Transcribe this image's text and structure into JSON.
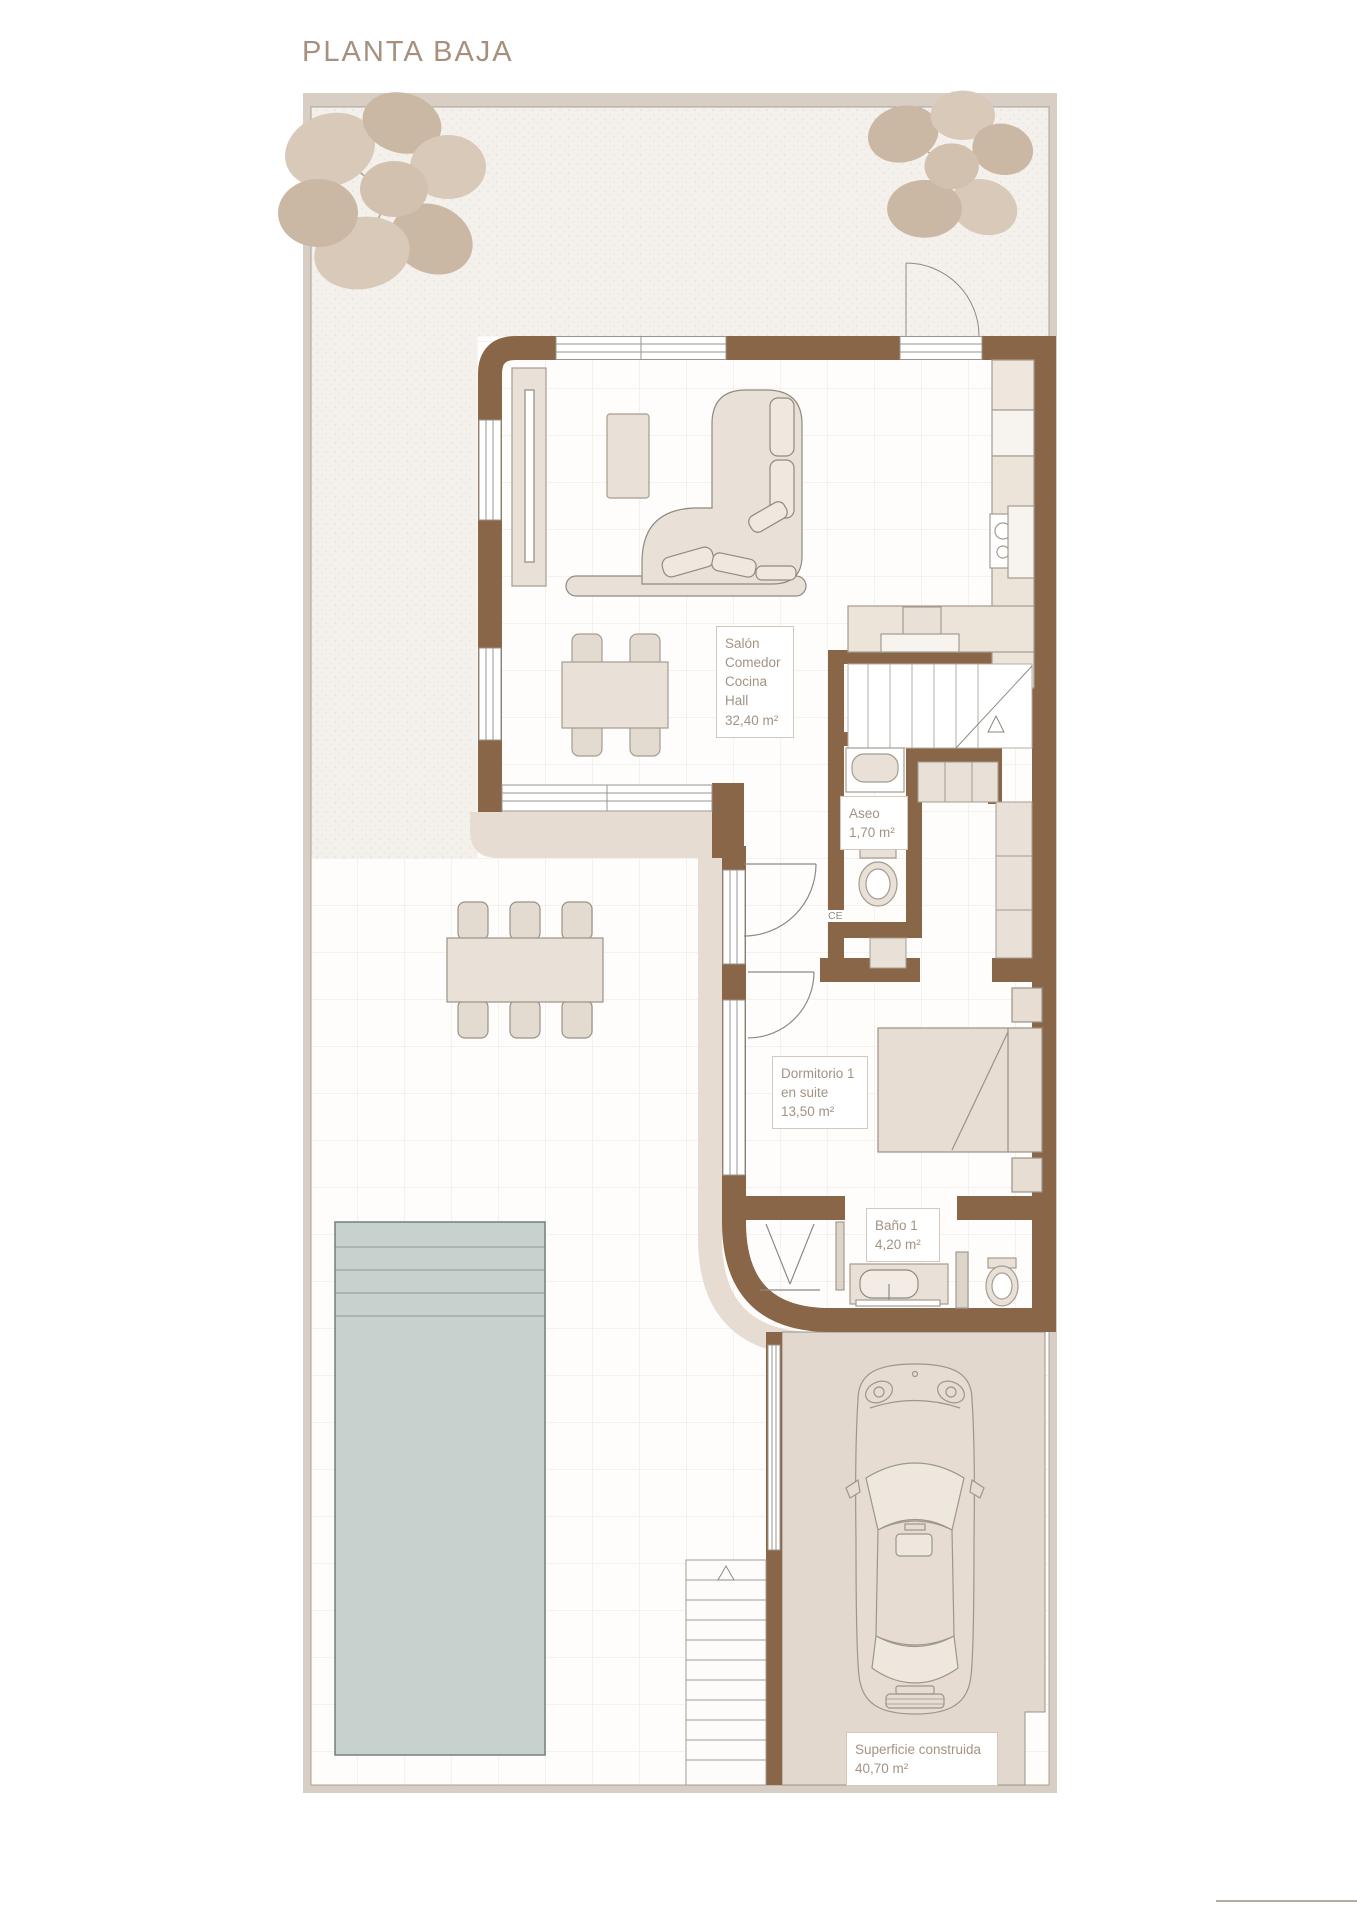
{
  "title": "PLANTA BAJA",
  "labels": {
    "salon": {
      "l1": "Salón",
      "l2": "Comedor",
      "l3": "Cocina",
      "l4": "Hall",
      "area": "32,40 m²"
    },
    "aseo": {
      "l1": "Aseo",
      "area": "1,70 m²"
    },
    "dormitorio": {
      "l1": "Dormitorio 1",
      "l2": "en suite",
      "area": "13,50 m²"
    },
    "bano": {
      "l1": "Baño 1",
      "area": "4,20 m²"
    },
    "superficie": {
      "l1": "Superficie construida",
      "area": "40,70 m²"
    },
    "ce": "CE"
  },
  "colors": {
    "wall_brown": "#8a6648",
    "path_beige": "#e6dcd2",
    "furniture_beige": "#e9e1d7",
    "garage_beige": "#e2d8cd",
    "pool_blue": "#c7d2cf",
    "label_text": "#a39383",
    "title_text": "#a5917e"
  }
}
